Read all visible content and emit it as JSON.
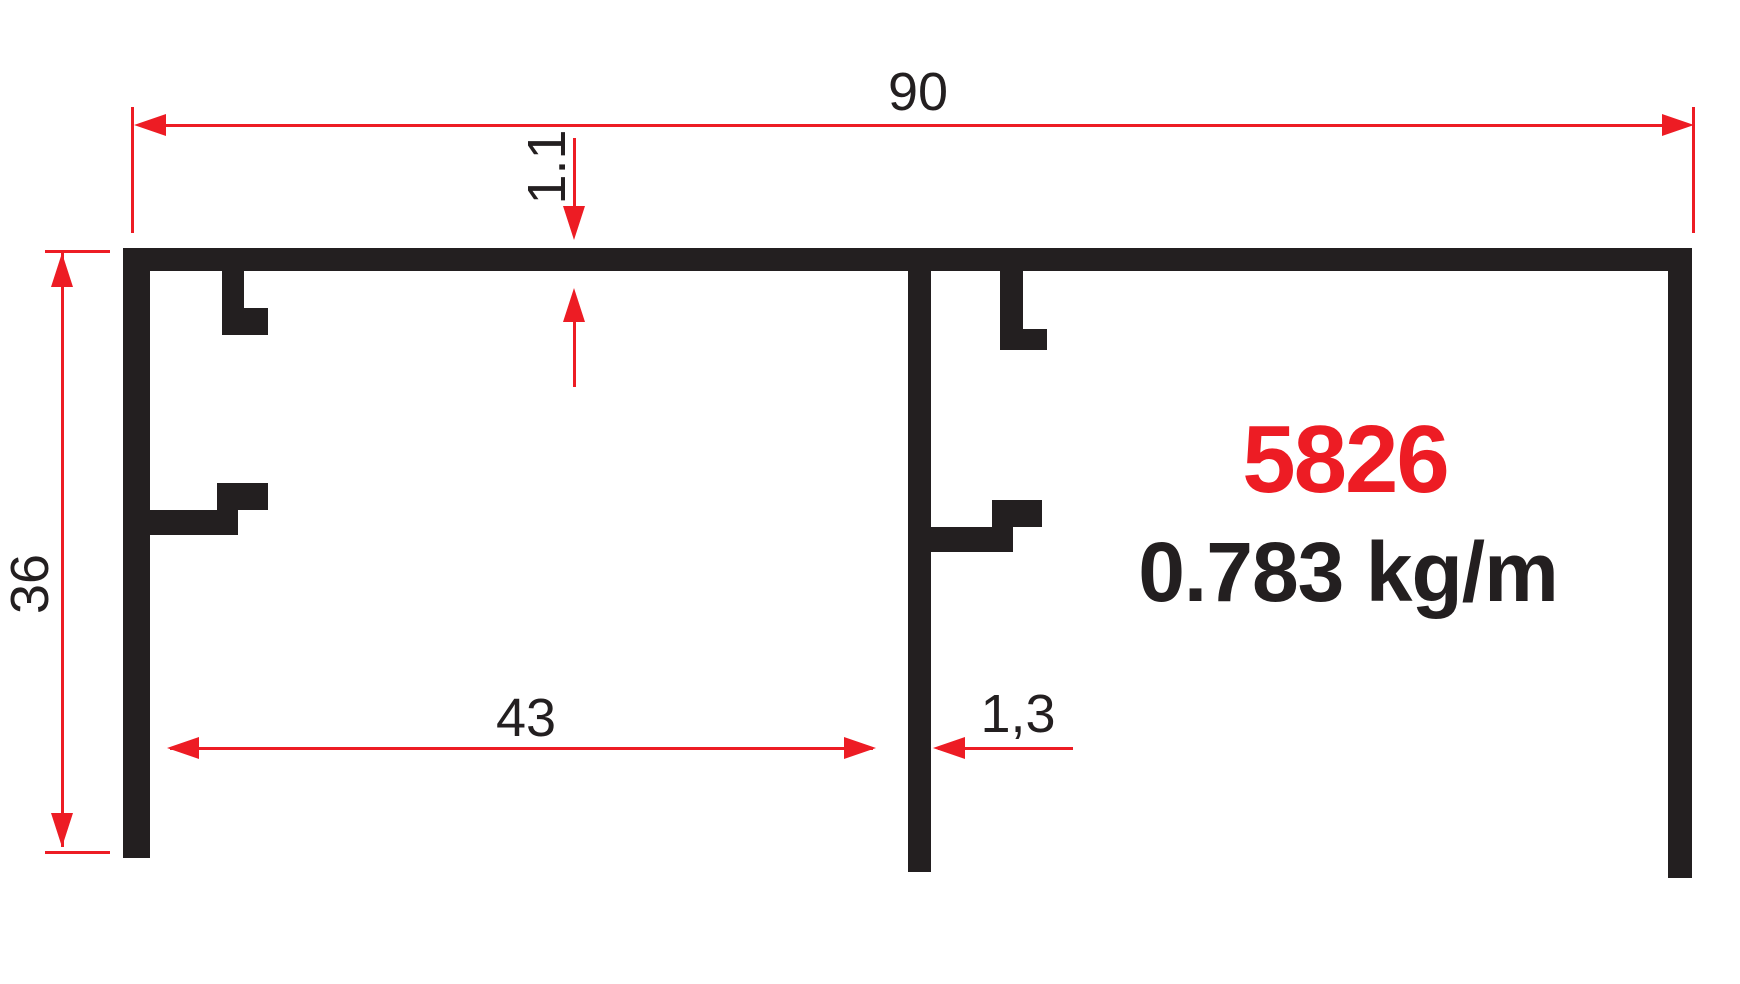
{
  "profile": {
    "code": "5826",
    "weight": "0.783 kg/m"
  },
  "dimensions": {
    "overall_width": "90",
    "top_wall_thickness": "1.1",
    "height": "36",
    "channel_width": "43",
    "wall_thickness": "1,3"
  },
  "colors": {
    "ink": "#231f20",
    "dimension_red": "#ed1c24",
    "background": "#ffffff"
  }
}
